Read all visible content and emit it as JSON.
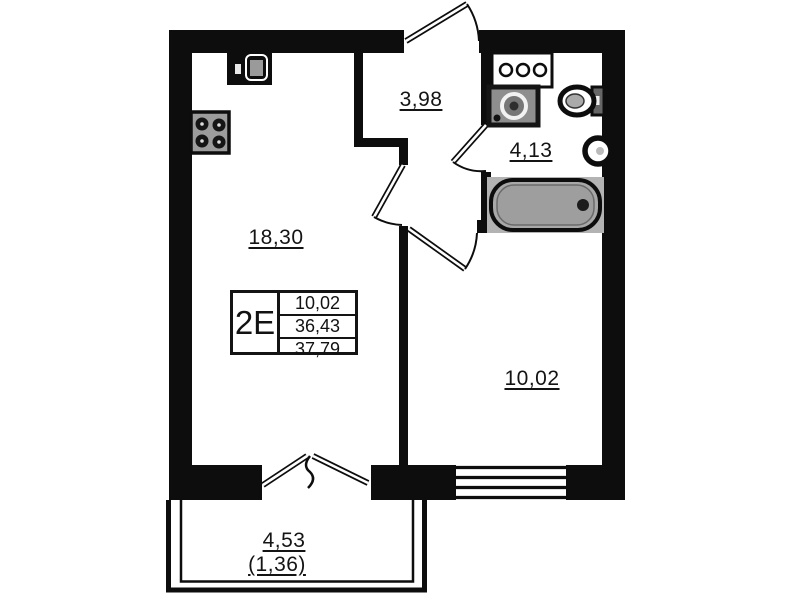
{
  "floorplan": {
    "unit": {
      "code": "2E",
      "area_rows": [
        "10,02",
        "36,43",
        "37,79"
      ]
    },
    "rooms": {
      "living_kitchen": "18,30",
      "hallway": "3,98",
      "bathroom": "4,13",
      "bedroom": "10,02",
      "balcony": "4,53",
      "balcony_coefficient": "(1,36)"
    },
    "fixtures": [
      "kitchen-sink-icon",
      "stove-icon",
      "bathroom-counter-icon",
      "washing-machine-icon",
      "toilet-icon",
      "wash-basin-icon",
      "bathtub-icon"
    ],
    "colors": {
      "wall": "#0d0d0d",
      "background": "#ffffff",
      "fixture_gray": "#a8a8a8",
      "text": "#141414"
    }
  }
}
